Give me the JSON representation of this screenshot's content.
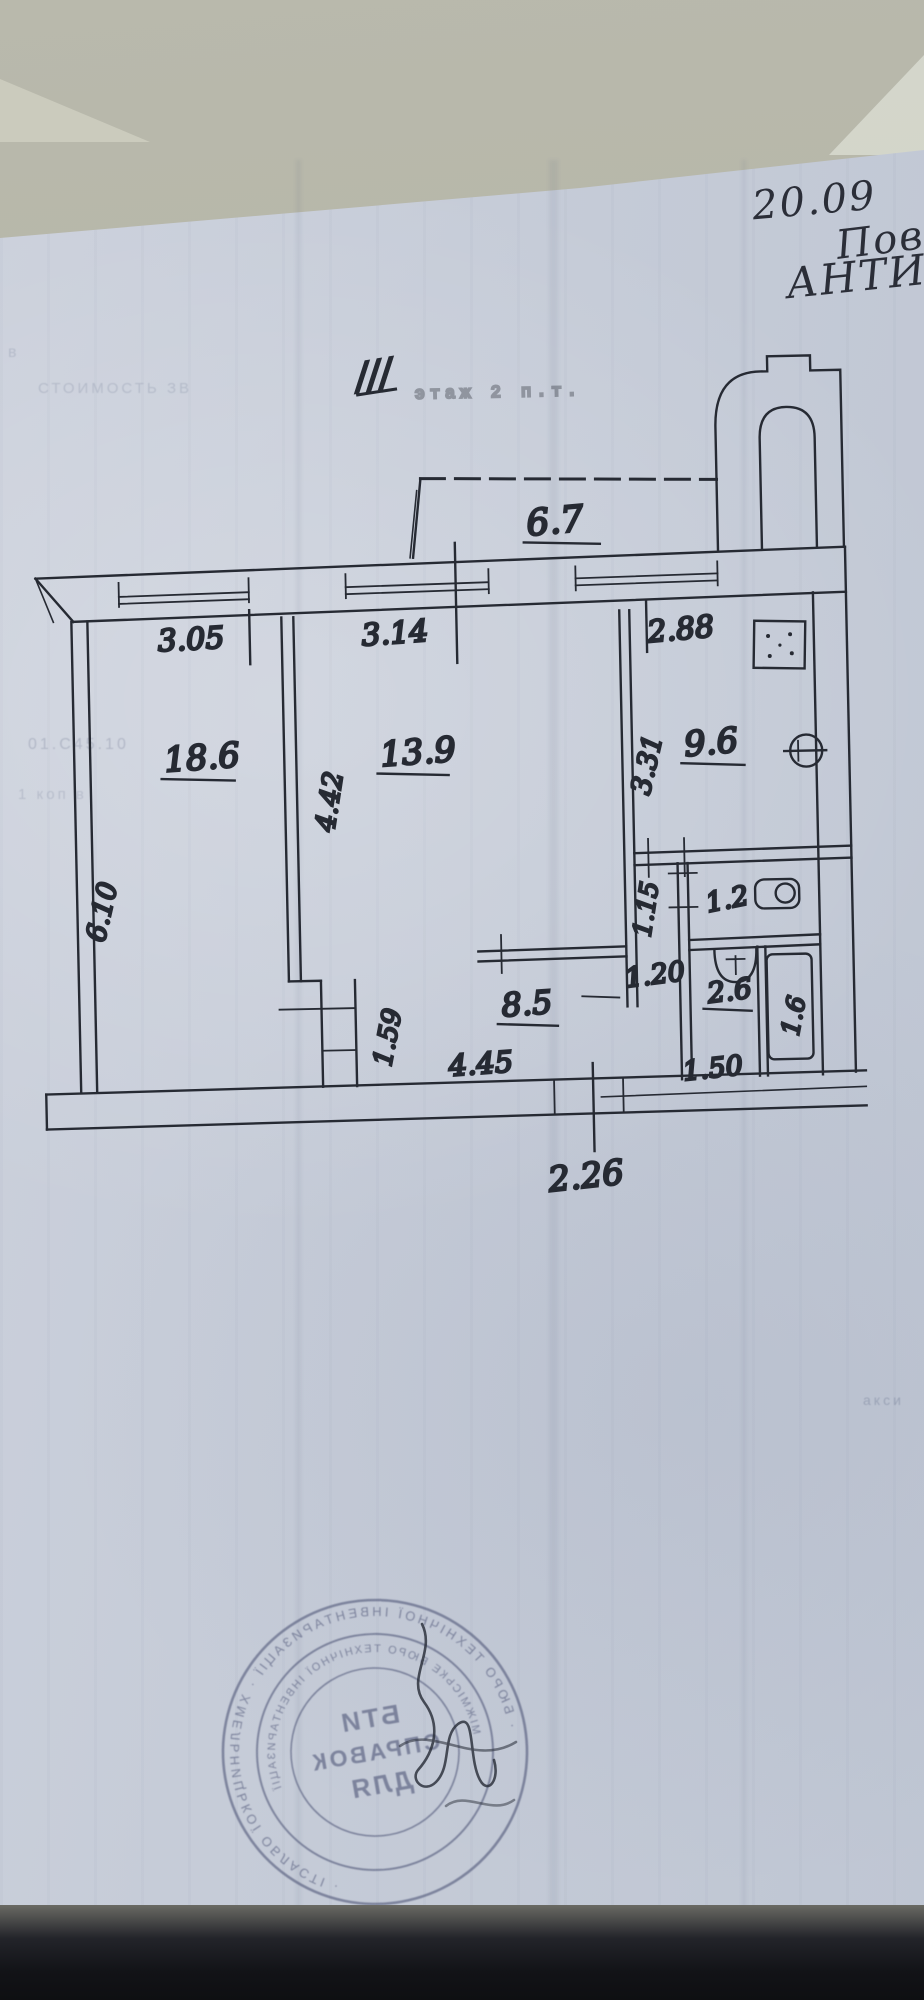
{
  "document": {
    "handwritten_notes": {
      "date": "20.09",
      "note_line_2": "Пове",
      "note_line_3": "АНТИ"
    },
    "floor_mark": {
      "slashes": "///",
      "stamp_text": "этаж 2 п.т."
    },
    "room_areas": {
      "balcony": "6.7",
      "room_left": "18.6",
      "room_middle": "13.9",
      "kitchen": "9.6",
      "hallway": "8.5",
      "wc": "1.2",
      "bathroom": "2.6",
      "bath_inner": "1.6"
    },
    "dimensions": {
      "top_left": "3.05",
      "top_middle": "3.14",
      "top_right": "2.88",
      "left_wall": "6.10",
      "middle_wall": "4.42",
      "kitchen_wall": "3.31",
      "hall_inner": "1.59",
      "corridor_width": "1.15",
      "corridor_depth": "1.20",
      "hallway_width": "4.45",
      "bathroom_width": "1.50",
      "bottom_exit": "2.26"
    },
    "stamp": {
      "line1": "БТИ",
      "line2": "СПРАВОК",
      "line3": "ДЛЯ",
      "ring_outer": "· БЮРО ТЕХНІЧНОЇ ІНВЕНТАРИЗАЦІЇ · ХМЕЛЬНИЦЬКОЇ ОБЛАСТІ ·",
      "ring_inner": "МІЖМІСЬКЕ БЮРО ТЕХНІЧНОЇ ІНВЕНТАРИЗАЦІЇ"
    },
    "bleed_fragments": [
      {
        "text": "в"
      },
      {
        "text": "СТОИМОСТЬ  ЗВ"
      },
      {
        "text": "01.С45.10"
      },
      {
        "text": "1 коп  в"
      },
      {
        "text": "акси"
      }
    ]
  },
  "colors": {
    "paper": "#c7ccd7",
    "table": "#b2b2a4",
    "ink": "#262a33",
    "stamp": "#4a5170"
  }
}
